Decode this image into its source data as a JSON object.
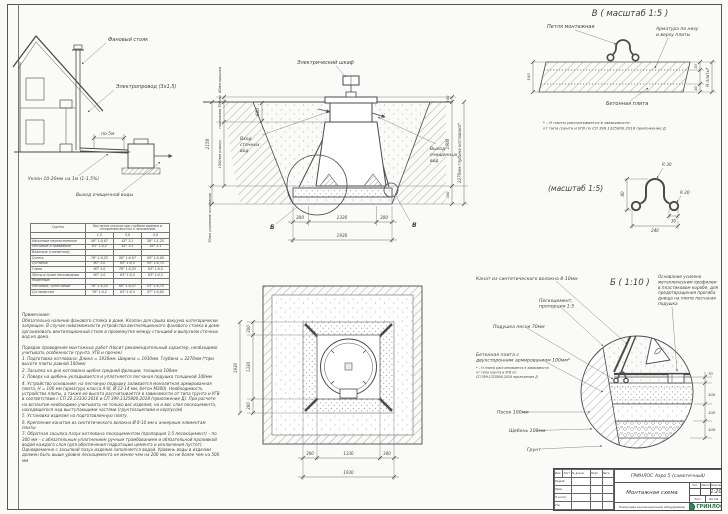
{
  "house": {
    "vent_stack": "Фановый стояк",
    "wire": "Электропровод (3х1,5)",
    "per5": "по 5м",
    "slope": "Уклон 10-20мм на 1м (1-1,5%)",
    "outlet": "Выход очищенной воды"
  },
  "section": {
    "cabinet": "Электрический шкаф",
    "inlet_l1": "Вход",
    "inlet_l2": "сточных",
    "inlet_l3": "вод",
    "outlet_l1": "Выход",
    "outlet_l2": "очищенных",
    "outlet_l3": "вод",
    "dim_lid": "60мм крышка",
    "dim_neck": "горловина 500мм",
    "dim_total": "2150",
    "dim_body": "1500мм корпус",
    "dim_base": "70мм усиление основания",
    "dim_600": "600",
    "dim_100": "100",
    "dim_1900": "1900",
    "dim_300": "300",
    "pit_depth": "2270мм глубина котлована*",
    "dim_b300a": "300",
    "dim_b1330": "1330",
    "dim_b300b": "300",
    "dim_b1930": "1930",
    "mark_b": "Б",
    "mark_v": "В"
  },
  "plan": {
    "l300a": "300",
    "l1330": "1330",
    "l300b": "300",
    "l1930": "1930",
    "b300a": "300",
    "b1330": "1330",
    "b300b": "300",
    "b1930": "1930"
  },
  "detail_v": {
    "title": "В ( масштаб 1:5 )",
    "loop": "Петля монтажная",
    "rebar_l1": "Арматура по низу",
    "rebar_l2": "и верху плиты",
    "slab": "Бетонная плита",
    "dim_100": "100",
    "dim_30t": "30",
    "dim_30b": "30",
    "dim_h": "Н плиты*",
    "fn1": "* – Н плиты рассчитывается в зависимости",
    "fn2": "от типа грунта и УГВ по СП 399.1325800.2018 приложение Д"
  },
  "profile": {
    "title": "(масштаб 1:5)",
    "r30": "R 30",
    "r20": "R 20",
    "dim80": "80",
    "dim30": "30",
    "dim240": "240"
  },
  "detail_b": {
    "title": "Б ( 1:10 )",
    "rope": "Канат из синтетического волокна 8-10мм",
    "pesco_l1": "Пескоцемент,",
    "pesco_l2": "пропорция 1:5",
    "cushion": "Подушка песок 70мм",
    "slab_l1": "Бетонная плита с",
    "slab_l2": "двухсторонним армированием 100мм*",
    "fn1": "* – Н плиты рассчитывается в зависимости",
    "fn2": "от типа грунта и УГВ по",
    "fn3": "СП 399.1325800.2018 приложение Д",
    "sand": "Песок 100мм",
    "gravel": "Щебень 100мм",
    "soil": "Грунт",
    "note_l1": "Основание усилено",
    "note_l2": "металлическим профилем",
    "note_l3": "в пластиковом коробе, для",
    "note_l4": "предотвращения прогиба",
    "note_l5": "днища на плите песчаная",
    "note_l6": "подушка",
    "dim70": "70",
    "dim100a": "100",
    "dim100b": "100",
    "dim100c": "100"
  },
  "table": {
    "col_soil": "Грунты",
    "col_main": "Крутизна откосов при глубине выемки и отношении высоты к заложению",
    "sub": [
      "1,5",
      "3,0",
      "5,0"
    ],
    "rows": [
      {
        "name": "Насыпные неуплотненные",
        "c1": "56° 1:0,67",
        "c2": "45° 1:1",
        "c3": "38° 1:1,25"
      },
      {
        "name": "Песчаные и гравийные",
        "c1": "63° 1:0,5",
        "c2": "45° 1:1",
        "c3": "45° 1:1"
      },
      {
        "name": "Влажные (глинистые):",
        "c1": "",
        "c2": "",
        "c3": ""
      },
      {
        "name": "Супесь",
        "c1": "76° 1:0,25",
        "c2": "56° 1:0,67",
        "c3": "50° 1:0,85"
      },
      {
        "name": "Суглинок",
        "c1": "90° 1:0",
        "c2": "63° 1:0,5",
        "c3": "53° 1:0,75"
      },
      {
        "name": "Глина",
        "c1": "90° 1:0",
        "c2": "76° 1:0,25",
        "c3": "63° 1:0,5"
      },
      {
        "name": "Лессы и сухие лессовидные",
        "c1": "90° 1:0",
        "c2": "63° 1:0,5",
        "c3": "63° 1:0,5"
      },
      {
        "name": "Моренные:",
        "c1": "",
        "c2": "",
        "c3": ""
      },
      {
        "name": "Песчаные, супесчаные",
        "c1": "76° 1:0,25",
        "c2": "60° 1:0,57",
        "c3": "53° 1:0,75"
      },
      {
        "name": "Суглинистые",
        "c1": "78° 1:0,2",
        "c2": "63° 1:0,5",
        "c3": "57° 1:0,65"
      }
    ]
  },
  "notes": {
    "heading": "Примечание:",
    "items": [
      "Обязательно наличие фанового стояка в доме. Клапан для срыва вакуума категорически запрещен. В случае невозможности устройства вентиляционного фанового стояка в доме организовать вентиляционный стояк в промежутке между станцией и выпуском сточных вод из дома.",
      "",
      "Порядок проведения монтажных работ (Носит рекомендательный характер, необходимо учитывать особенности грунта, УГВ и прочее)",
      "1. Подготовка котлована: Длина = 1930мм. Ширина = 1930мм. Глубина = 2270мм (*при высоте плиты равной 100мм)",
      "2. Засыпка на дно котлована щебня средней фракции, толщина 100мм",
      "3. Поверх на щебень укладывается и уплотняется песчаная подушка толщиной 100мм",
      "4. Устройство основания: на песчаную подушку заливается монолитная армированная плита, Н = 100 мм (арматура класса А-III, Ø 12-14 мм, бетон М300). Необходимость устройства плиты, а также ее высота рассчитывается в зависимости от типа грунта и УГВ в соответствии с СП 22.13330.2016 и СП 399.1325800.2018 (приложение Д). При расчете на всплытие необходимо учитывать не только вес изделия, но и вес слоя пескоцемента, находящегося над выступающими частями (грунтозацепами и корпусом)",
      "5. Установка изделия на подготовленную плиту.",
      "6. Крепление канатом из синтетического волокна Ø 8-10 мм к анкерным элементам плиты",
      "7. Обратная засыпка пазух котлована пескоцементом (пропорция 1:5 песок/цемент) – по 300 мм – с обязательным уплотнением ручным трамбованием и обязательной проливкой водой каждого слоя (для обеспечения гидратации цемента и исключения пустот). Одновременно с засыпкой пазух изделие заполняется водой. Уровень воды в изделии должен быть выше уровня пескоцемента не менее чем на 200 мм, но не более чем на 500 мм"
    ]
  },
  "titleblock": {
    "product": "ГРИНЛОС Аэро 5 (самотечный)",
    "doc_title": "Монтажная схема",
    "subtitle": "Наилучшее канализационное оборудование",
    "brand": "ГРИНЛОС",
    "lit_label": "Лит.",
    "mass_label": "Масса",
    "scale_label": "Масштаб",
    "scale": "1:20",
    "sheet_label": "Лист",
    "sheets_label": "Листов",
    "hdr": [
      "Изм.",
      "Лист",
      "№ докум.",
      "Подп.",
      "Дата"
    ],
    "roles": [
      "Разраб.",
      "Пров.",
      "Н.контр.",
      "Утв."
    ]
  }
}
